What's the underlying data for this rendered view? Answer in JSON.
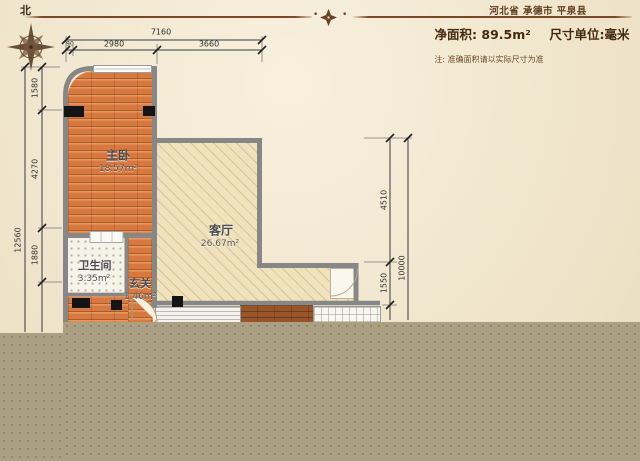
{
  "header": {
    "north": "北",
    "location": "河北省 承德市 平泉县",
    "net_area_label": "净面积:",
    "net_area_value": "89.5m²",
    "unit_label": "尺寸单位:毫米",
    "note": "注: 准确面积请以实际尺寸为准",
    "divider_dot_left": "•",
    "divider_dot_right": "•"
  },
  "rooms": [
    {
      "name": "主卧",
      "area": "18.57m²"
    },
    {
      "name": "客厅",
      "area": "26.67m²"
    },
    {
      "name": "卫生间",
      "area": "3.35m²"
    },
    {
      "name": "玄关",
      "area": "1.46m²"
    }
  ],
  "dimensions": {
    "top_total": "7160",
    "top_seg_small": "90",
    "top_seg1": "2980",
    "top_seg2": "3660",
    "left_total": "12560",
    "left_seg1": "1580",
    "left_seg2": "4270",
    "left_seg3": "1880",
    "right_total": "10000",
    "right_seg1": "4510",
    "right_seg2": "1550"
  },
  "icons": {
    "compass_rose": "eight-point-star",
    "florette": "diamond-cluster"
  },
  "colors": {
    "paper": "#f2e8d1",
    "accent_brown": "#7a4a28",
    "wood_floor": "#d87a40",
    "dark_wood": "#98552a",
    "living_floor": "#f0e2bc",
    "wall_gray": "#878787",
    "cutoff_overlay": "#aca084"
  }
}
